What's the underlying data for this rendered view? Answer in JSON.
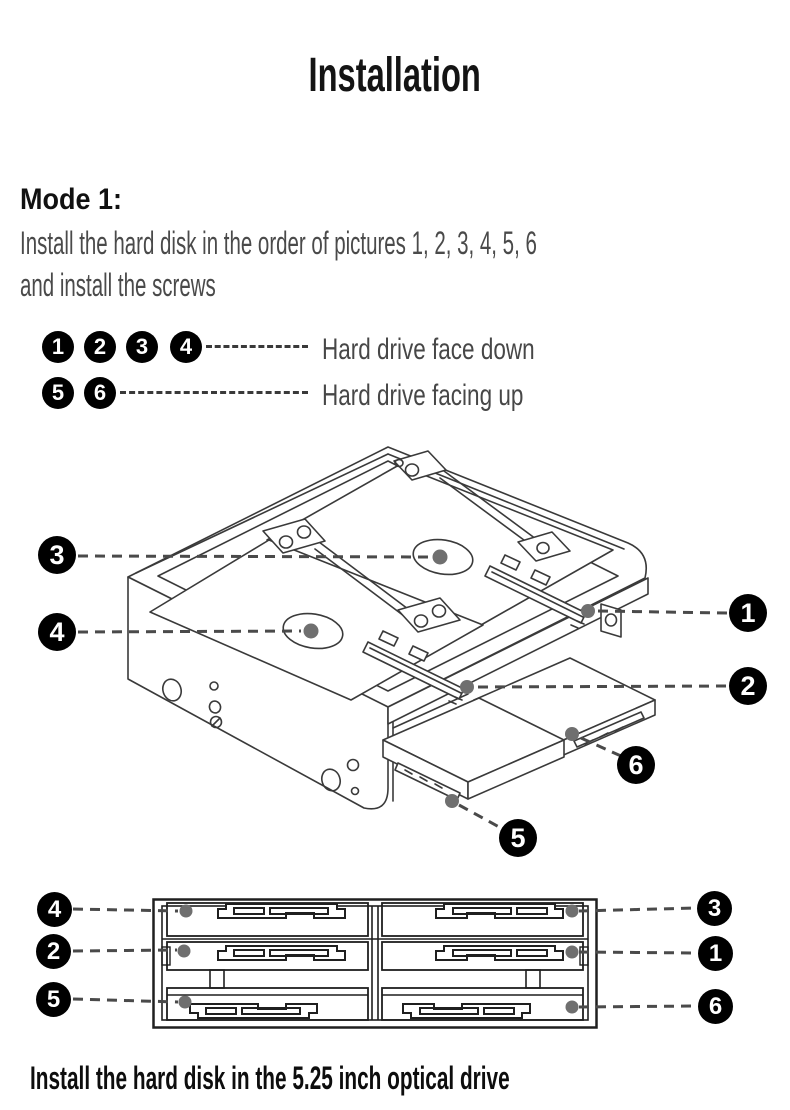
{
  "title": "Installation",
  "section": {
    "heading": "Mode 1:",
    "line1": "Install the hard disk in the order of pictures 1, 2, 3, 4, 5, 6",
    "line2": "and install the screws"
  },
  "legend": {
    "rows": [
      {
        "badges": [
          "1",
          "2",
          "3",
          "4"
        ],
        "label": "Hard drive face down"
      },
      {
        "badges": [
          "5",
          "6"
        ],
        "label": "Hard drive facing up"
      }
    ]
  },
  "iso": {
    "c1": "1",
    "c2": "2",
    "c3": "3",
    "c4": "4",
    "c5": "5",
    "c6": "6"
  },
  "front": {
    "left": [
      "4",
      "2",
      "5"
    ],
    "right": [
      "3",
      "1",
      "6"
    ]
  },
  "caption": "Install the hard disk in the 5.25 inch optical drive",
  "colors": {
    "badge_bg": "#000000",
    "badge_text": "#ffffff",
    "diagram_line": "#3a3a3a",
    "front_line": "#1f1f1f",
    "text_muted": "#4a4a4a",
    "screw_dot": "#6f6f6f"
  }
}
